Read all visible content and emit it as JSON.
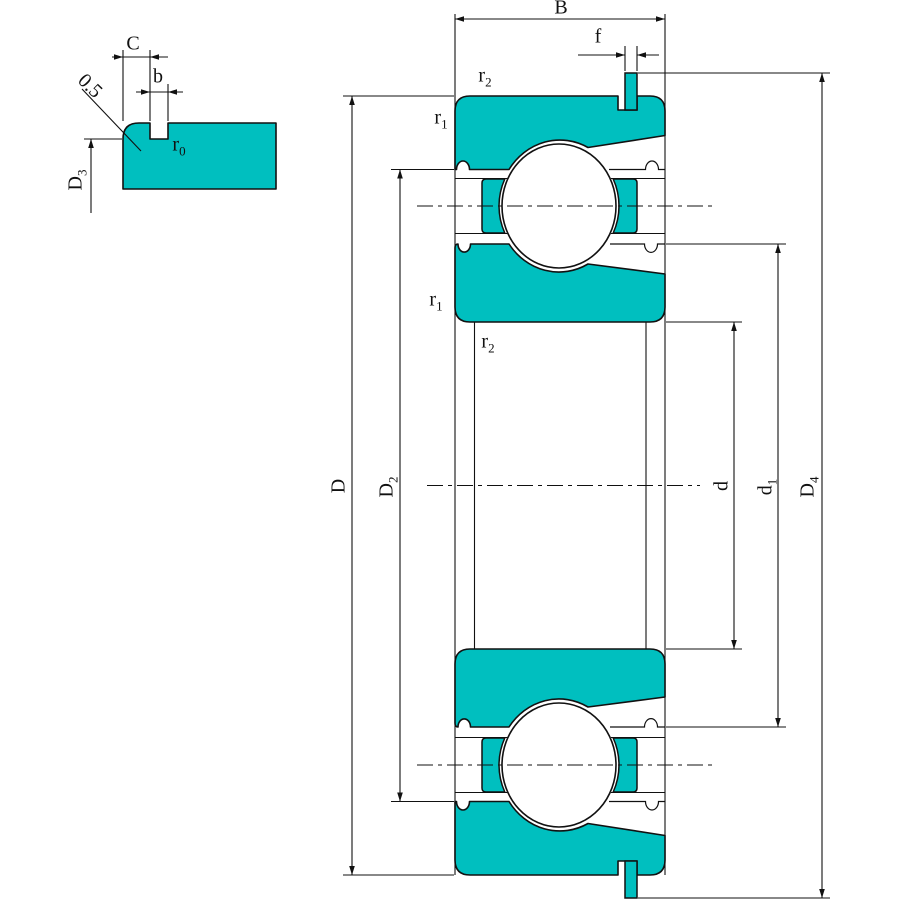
{
  "title": "Ball bearing with snap ring — dimensioned cross-section drawing",
  "colors": {
    "part_fill": "#00bfbf",
    "line": "#111111",
    "background": "#ffffff"
  },
  "detail_view": {
    "labels": {
      "C": {
        "base": "C"
      },
      "b": {
        "base": "b"
      },
      "chamfer": {
        "base": "0.5"
      },
      "r0": {
        "base": "r",
        "sub": "0"
      },
      "D3": {
        "base": "D",
        "sub": "3"
      }
    }
  },
  "main_view": {
    "labels": {
      "B": {
        "base": "B"
      },
      "f": {
        "base": "f"
      },
      "r2_top": {
        "base": "r",
        "sub": "2"
      },
      "r1_top": {
        "base": "r",
        "sub": "1"
      },
      "r1_bot": {
        "base": "r",
        "sub": "1"
      },
      "r2_bot": {
        "base": "r",
        "sub": "2"
      },
      "D": {
        "base": "D"
      },
      "D2": {
        "base": "D",
        "sub": "2"
      },
      "d": {
        "base": "d"
      },
      "d1": {
        "base": "d",
        "sub": "1"
      },
      "D4": {
        "base": "D",
        "sub": "4"
      }
    }
  }
}
